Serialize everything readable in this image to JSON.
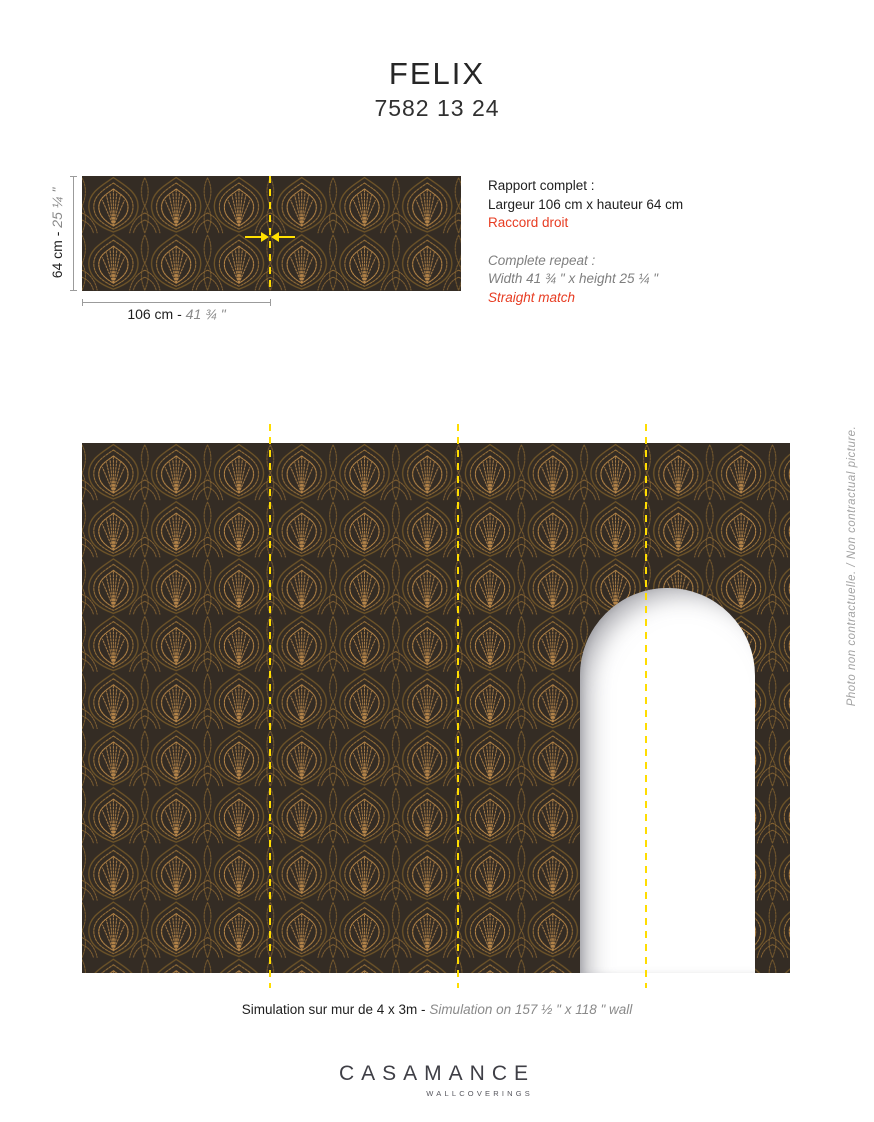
{
  "header": {
    "title": "FELIX",
    "reference": "7582 13 24"
  },
  "repeat_block": {
    "fr_title": "Rapport complet :",
    "fr_size": "Largeur 106 cm x hauteur 64 cm",
    "fr_match": "Raccord droit",
    "en_title": "Complete repeat :",
    "en_size": "Width 41 ¾ \" x height 25 ¼ \"",
    "en_match": "Straight match"
  },
  "swatch": {
    "height_cm": "64 cm - ",
    "height_in": "25 ¼ \"",
    "width_cm": "106 cm - ",
    "width_in": "41 ¾ \""
  },
  "simulation": {
    "caption_fr": "Simulation sur mur de 4 x 3m - ",
    "caption_en": "Simulation on 157 ½ \" x 118 \" wall",
    "disclaimer": "Photo non contractuelle. / Non contractual picture."
  },
  "brand": {
    "name": "CASAMANCE",
    "division": "WALLCOVERINGS"
  },
  "colors": {
    "accent_red": "#e73c22",
    "seam_yellow": "#ffdd00",
    "pattern_gold": "#b08044",
    "pattern_background": "#342c24",
    "dimension_gray": "#9b9b9b",
    "secondary_text_gray": "#8a8a8a"
  }
}
